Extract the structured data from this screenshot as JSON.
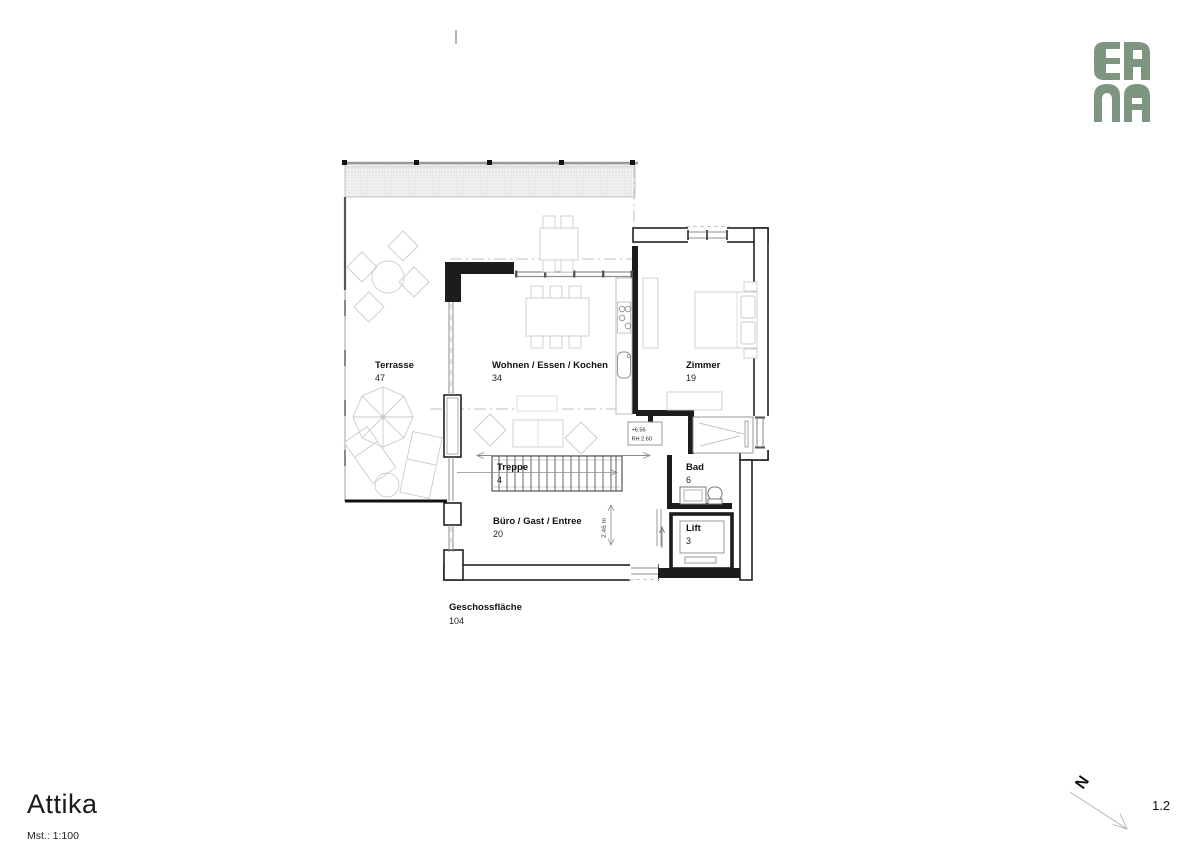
{
  "logo": {
    "line1": "ER",
    "line2": "NA",
    "color": "#7e957f"
  },
  "titleblock": {
    "title": "Attika",
    "scale": "Mst.: 1:100",
    "sheet": "1.2",
    "north": "N"
  },
  "rooms": [
    {
      "name": "Terrasse",
      "area": "47"
    },
    {
      "name": "Wohnen / Essen / Kochen",
      "area": "34"
    },
    {
      "name": "Zimmer",
      "area": "19"
    },
    {
      "name": "Treppe",
      "area": "4"
    },
    {
      "name": "Bad",
      "area": "6"
    },
    {
      "name": "Büro / Gast / Entree",
      "area": "20"
    },
    {
      "name": "Lift",
      "area": "3"
    },
    {
      "name": "Geschossfläche",
      "area": "104"
    }
  ],
  "annotations": {
    "elevation": "+6.56",
    "clear_height": "RH 2.60",
    "stair_width": "2.46 m"
  }
}
